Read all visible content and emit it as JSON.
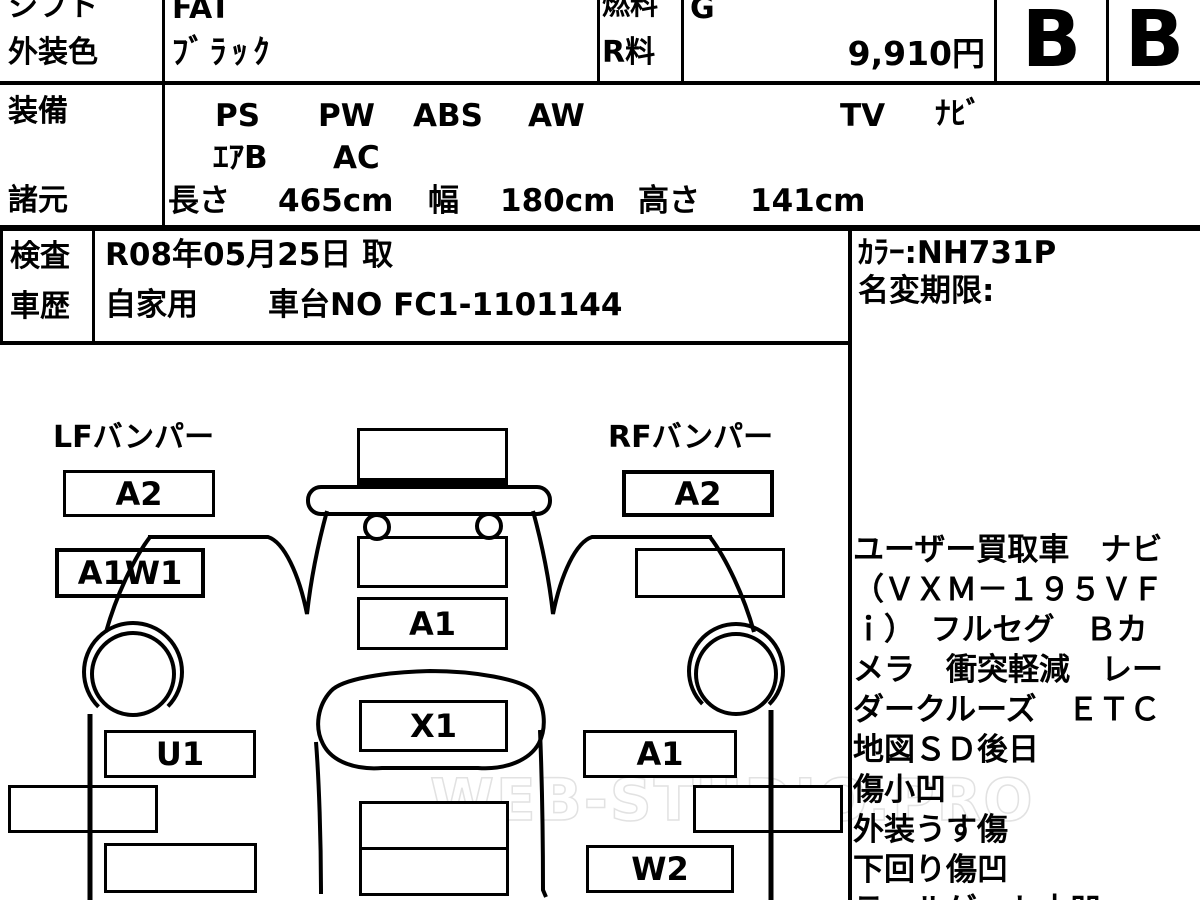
{
  "title_row": {
    "shift_label": "シフト",
    "shift_value": "FAT",
    "fuel_label": "燃料",
    "fuel_value": "G"
  },
  "color_row": {
    "label": "外装色",
    "value": "ﾌﾞﾗｯｸ",
    "r_label": "R料",
    "r_value": "9,910円"
  },
  "grades": {
    "overall": "B",
    "interior": "B"
  },
  "equipment": {
    "label": "装備",
    "row1": [
      "PS",
      "PW",
      "ABS",
      "AW",
      "TV",
      "ﾅﾋﾞ"
    ],
    "row2": [
      "ｴｱB",
      "AC"
    ]
  },
  "specs": {
    "label": "諸元",
    "items": [
      "長さ",
      "465cm",
      "幅",
      "180cm",
      "高さ",
      "141cm"
    ]
  },
  "inspection": {
    "label": "検査",
    "value": "R08年05月25日 取"
  },
  "history": {
    "label": "車歴",
    "use": "自家用",
    "chassis": "車台NO FC1-1101144"
  },
  "color_info": {
    "code": "ｶﾗｰ:NH731P",
    "name_change": "名変期限:"
  },
  "diagram": {
    "lf_bumper_label": "LFバンパー",
    "rf_bumper_label": "RFバンパー",
    "codes": {
      "lf_bumper": "A2",
      "lf_fender": "A1W1",
      "l_door": "U1",
      "hood": "A1",
      "front_panel": "X1",
      "rf_bumper": "A2",
      "rf_door": "A1",
      "r_sill": "W2"
    }
  },
  "notes": {
    "lines": [
      "ユーザー買取車　ナビ",
      "（ＶＸＭ－１９５ＶＦ",
      "ｉ）　フルセグ　Ｂカ",
      "メラ　衝突軽減　レー",
      "ダークルーズ　ＥＴＣ",
      "地図ＳＤ後日",
      "傷小凹",
      "外装うす傷",
      "下回り傷凹",
      "テールゲート小凹"
    ]
  },
  "watermark": "WEB-STUDIO.PRO"
}
